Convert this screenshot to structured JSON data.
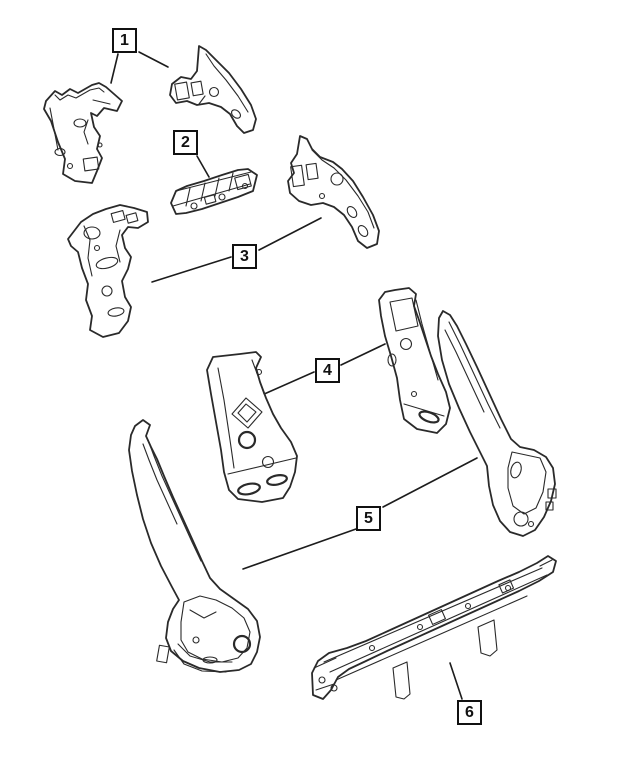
{
  "figure": {
    "type": "exploded-parts-line-diagram",
    "description_visible_text_only": true,
    "background_color": "#ffffff",
    "line_color": "#2a2a2a",
    "callout_border_color": "#111111",
    "callouts": [
      {
        "label": "1"
      },
      {
        "label": "2"
      },
      {
        "label": "3"
      },
      {
        "label": "4"
      },
      {
        "label": "5"
      },
      {
        "label": "6"
      }
    ]
  }
}
